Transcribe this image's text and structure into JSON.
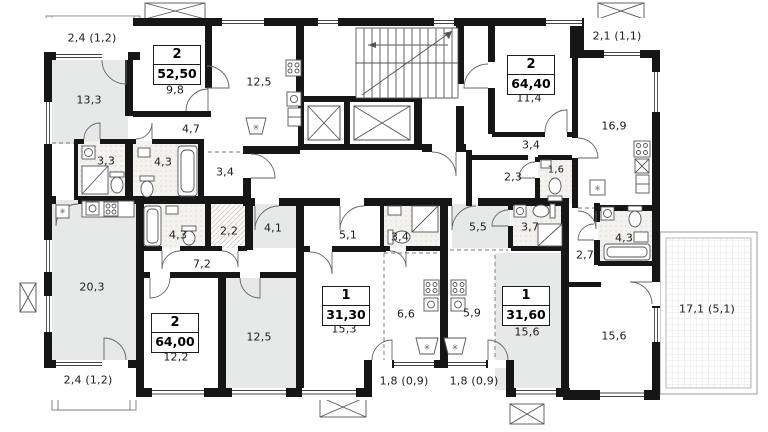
{
  "title": "Floor plan",
  "apartments": [
    {
      "rooms": "2",
      "area": "52,50"
    },
    {
      "rooms": "2",
      "area": "64,40"
    },
    {
      "rooms": "2",
      "area": "64,00"
    },
    {
      "rooms": "1",
      "area": "31,30"
    },
    {
      "rooms": "1",
      "area": "31,60"
    }
  ],
  "room_labels": [
    "13,3",
    "9,8",
    "12,5",
    "4,7",
    "3,3",
    "4,3",
    "3,4",
    "2,3",
    "1,6",
    "3,4",
    "11,4",
    "16,9",
    "20,3",
    "12,2",
    "12,5",
    "4,3",
    "2,2",
    "7,2",
    "4,1",
    "5,1",
    "3,4",
    "5,5",
    "3,7",
    "15,3",
    "6,6",
    "5,9",
    "15,6",
    "15,6",
    "2,7",
    "4,3"
  ],
  "outdoor_labels": [
    "2,4 (1,2)",
    "2,1 (1,1)",
    "2,4 (1,2)",
    "1,8 (0,9)",
    "1,8 (0,9)",
    "17,1 (5,1)"
  ],
  "colors": {
    "wall": "#161616",
    "room_gray": "#e7e9e9",
    "tile_bg": "#f4f2ee",
    "hatch_line": "#d9d9d9",
    "line": "#555555"
  }
}
